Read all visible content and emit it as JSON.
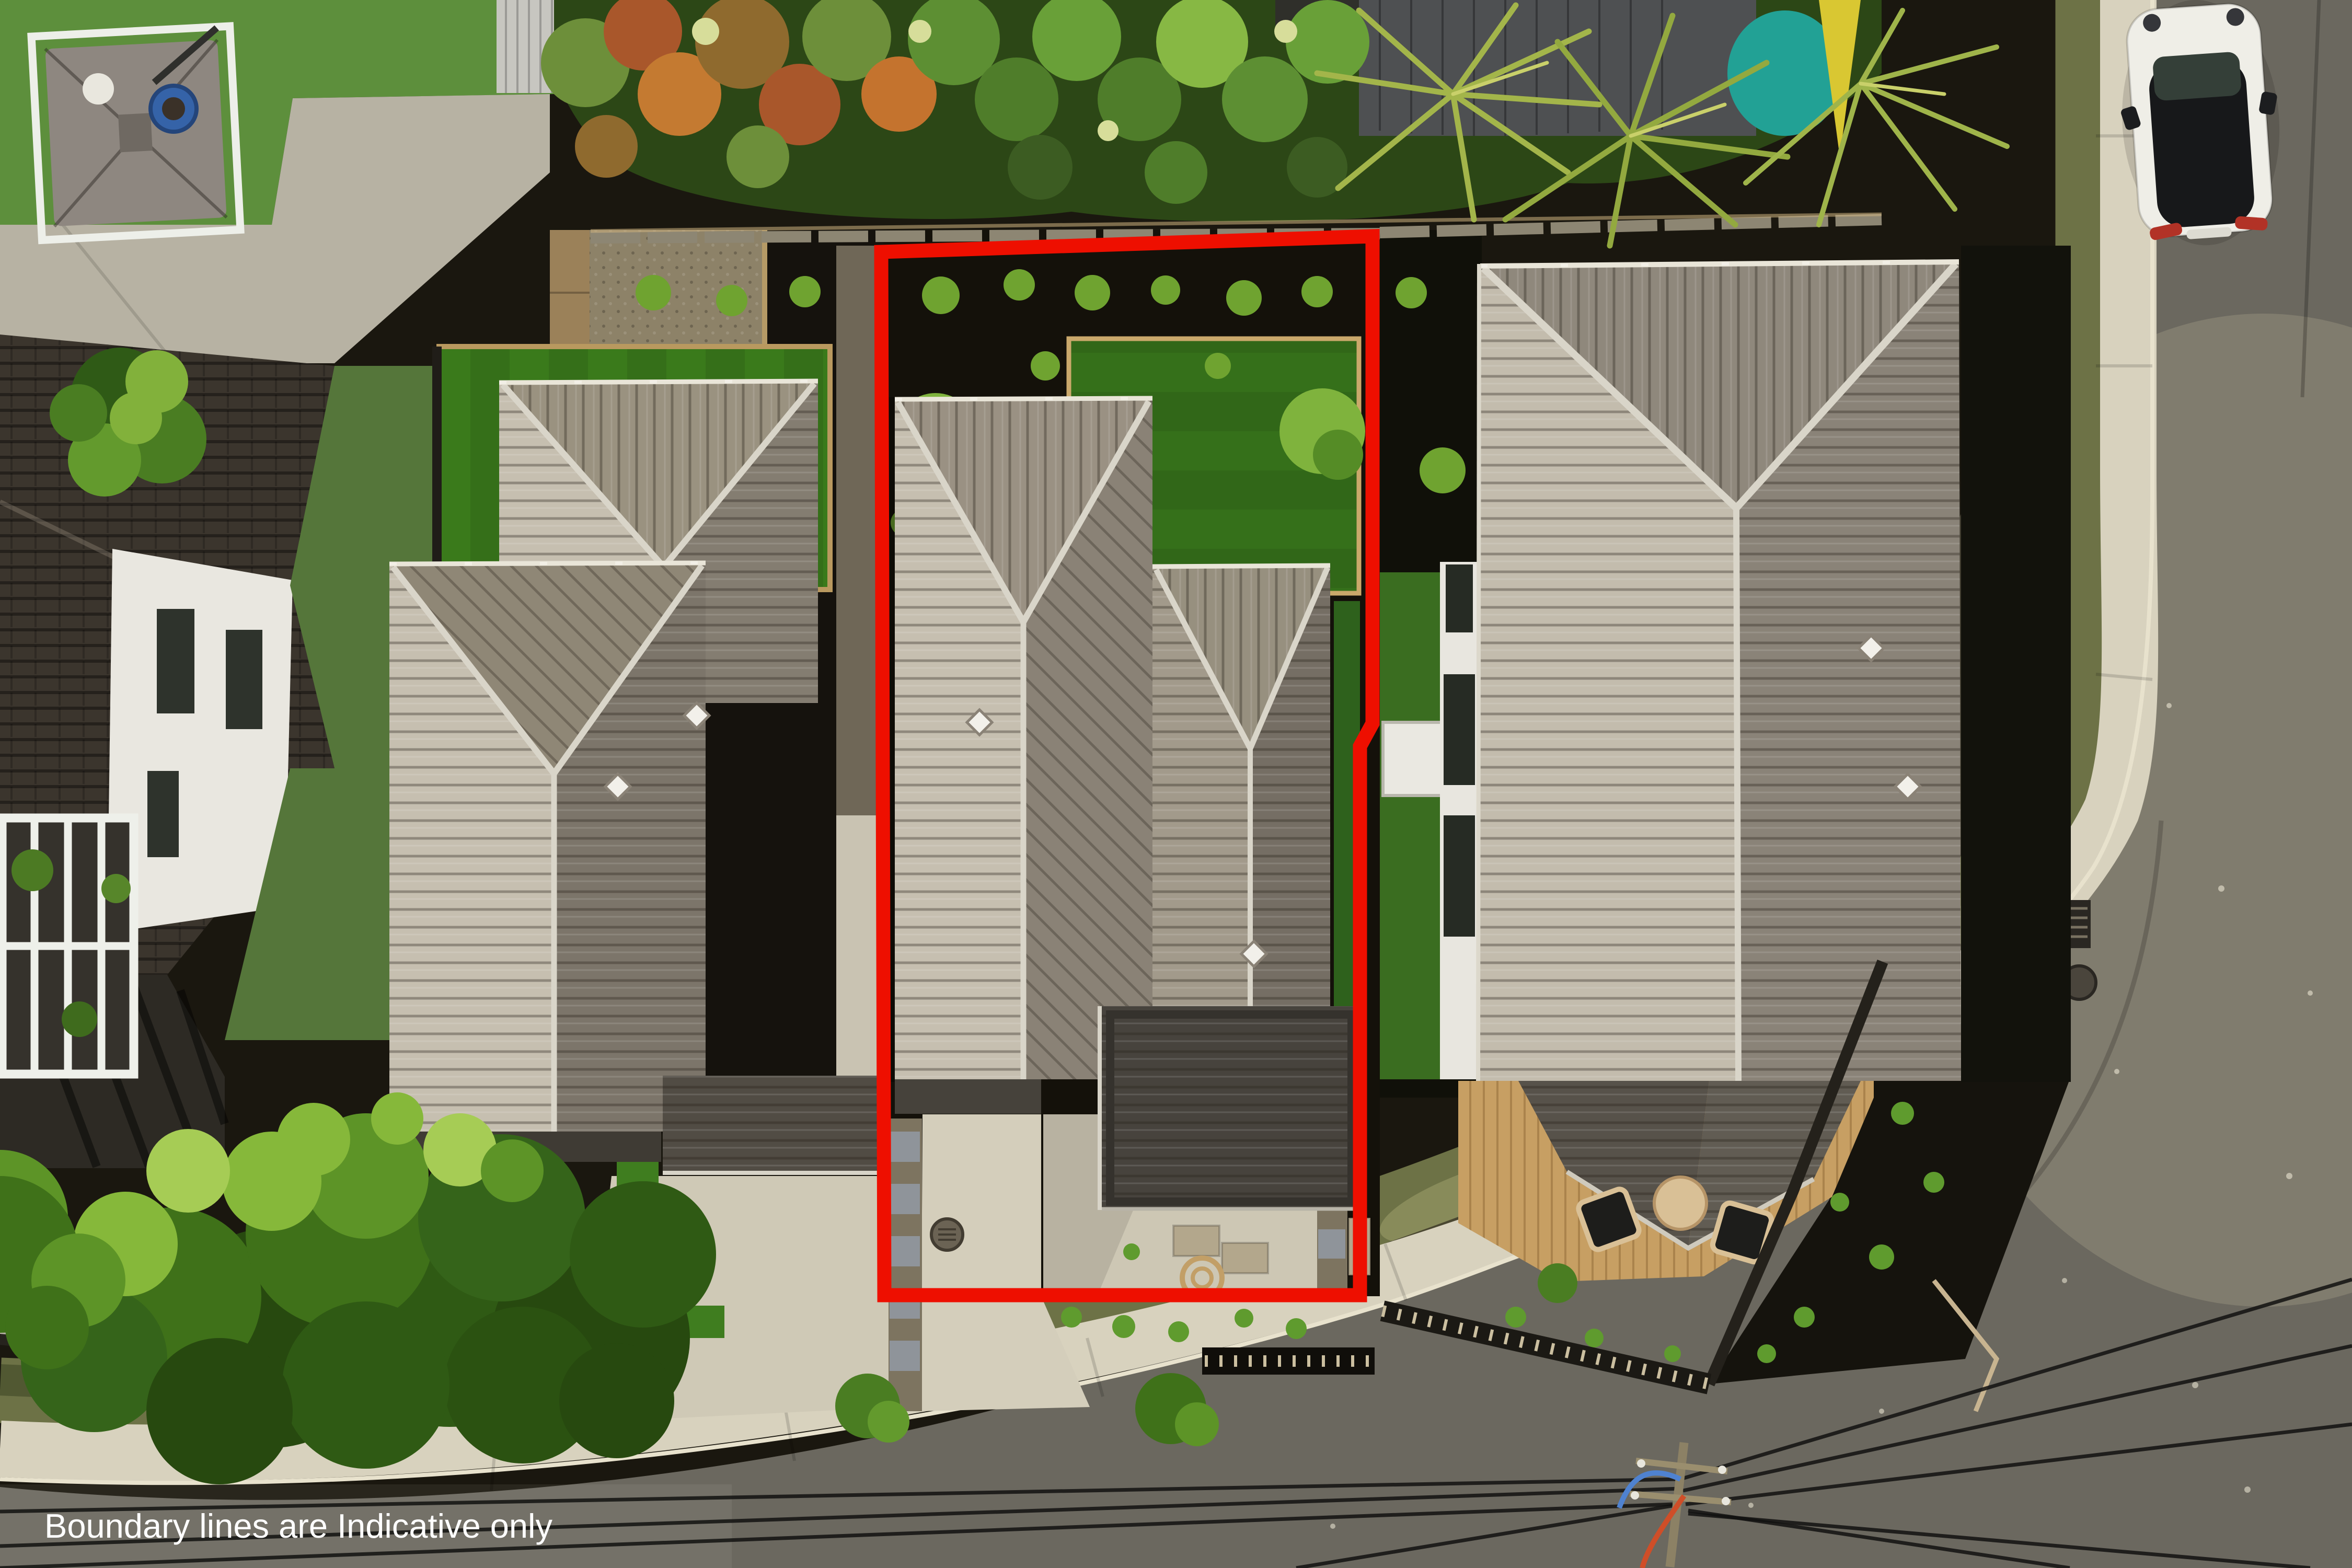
{
  "photo": {
    "type": "aerial-drone-photograph",
    "subject": "residential townhouse development with highlighted lot"
  },
  "caption": {
    "text": "Boundary lines are Indicative only",
    "color": "#ffffff"
  },
  "boundary": {
    "color": "#ee0f00",
    "style": "solid",
    "meaning": "indicative property boundary"
  },
  "scene": {
    "objects": [
      "subject-townhouse-roof",
      "neighbour-duplex-roofs",
      "neighbour-building-east",
      "dark-roof-house-west",
      "patio-umbrella",
      "white-canoe",
      "artificial-turf-lawns",
      "black-mulch-garden-beds",
      "timber-back-fence",
      "palm-trees",
      "hedge",
      "large-tree-canopy",
      "concrete-driveways",
      "footpath",
      "asphalt-road",
      "parked-white-car",
      "power-pole-and-wires",
      "wooden-deck-with-chairs"
    ],
    "palette": {
      "roof_light": "#c6bfb0",
      "roof_mid": "#978f7f",
      "roof_dark": "#7c756a",
      "roof_charcoal": "#47433d",
      "turf": "#3a7a1b",
      "mulch": "#15120d",
      "road": "#6b685f",
      "footpath": "#d8d2be",
      "deck": "#c79f63"
    }
  }
}
